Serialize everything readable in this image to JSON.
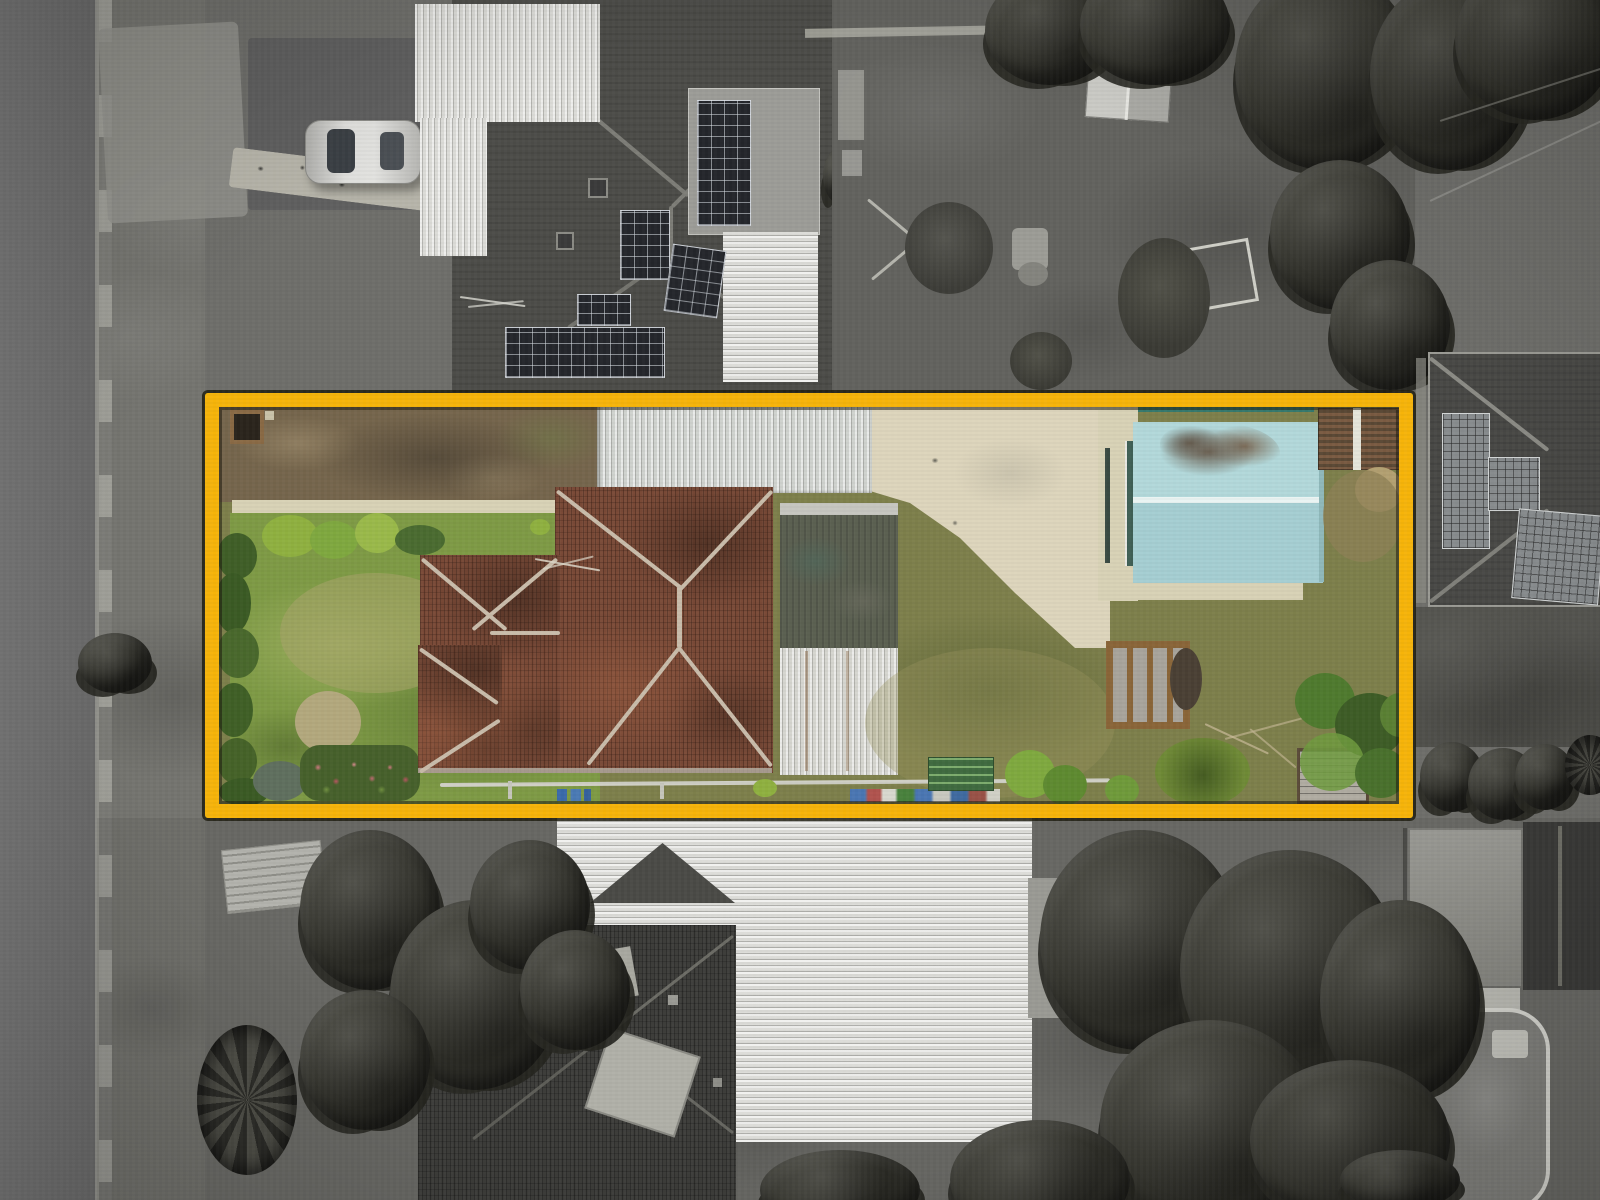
{
  "meta": {
    "kind": "aerial drone photograph (top-down real-estate shot)",
    "width_px": 1600,
    "height_px": 1200,
    "treatment": "surrounding neighbourhood desaturated to grayscale; highlighted lot shown in full colour",
    "visible_text": "none"
  },
  "highlight": {
    "label": "property boundary",
    "shape": "rectangle",
    "color": "#F6B40A",
    "outline": "#26241A",
    "x": 205,
    "y": 393,
    "width": 1208,
    "height": 425,
    "stroke_px": 14
  },
  "palette": {
    "base": "#6e6e6a",
    "road": "#6d6d6d",
    "verge": "#74746f",
    "yardDirtGray": "#62625e",
    "yardDark": "#50504b",
    "drivewayPad": "#5f5f5f",
    "roofDark": "#4d4d49",
    "roofDark2": "#494946",
    "roofDarkTile": "#3e3e3b",
    "grayRoof": "#8f8f89",
    "gableDark": "#393937",
    "corrLight": "#dcdcd8",
    "panelGray": "#9c9c97",
    "solarDark": "#24262b",
    "solarGray": "#888c8e",
    "trailerGray": "#b3b3ad",
    "carBody": "#d6d6d2",
    "poolWater": "#7d7d79",
    "poolDeck": "#b8b8b1",
    "lawnLeft": "#7e9a45",
    "lawnRight": "#7d7f4b",
    "dirt": "#75654c",
    "concrete": "#d8d2b6",
    "concreteDrive": "#ddd5bc",
    "terracotta": "#7a4a37",
    "ridgeCap": "#c9bcaa",
    "roofOldGreen": "#5c6152",
    "rearRoofWhite": "#d6d6d0",
    "carport": "#cfd2ce",
    "shedBlueTop": "#b2d8da",
    "shedBlueBottom": "#a5ced2",
    "shedRidge": "#eaf4f3",
    "rustShed": "#6e5948",
    "graySheds": "#b0aca2",
    "deckFrame": "#8a6538",
    "tealFence": "#2e7a72",
    "hedge": "#3f5e27",
    "bushBright": "#8fb040",
    "fern": "#6f8a36",
    "flowerBed": "#46602b"
  },
  "lot": {
    "features": [
      {
        "name": "main-house-tiled-roof",
        "desc": "terracotta hip roof with light ridge capping"
      },
      {
        "name": "old-green-metal-roof",
        "desc": "weathered green-grey rear section"
      },
      {
        "name": "white-rear-roof",
        "desc": "white corrugated rear extension"
      },
      {
        "name": "carport-roof",
        "desc": "long light corrugated roof along top boundary"
      },
      {
        "name": "concrete-driveway",
        "desc": "cream concrete with curved lawn edge"
      },
      {
        "name": "blue-shed",
        "desc": "pale blue gabled garage with rust patch and white ridge"
      },
      {
        "name": "rust-shed",
        "desc": "small rusty roof in top-right corner"
      },
      {
        "name": "timber-deck",
        "desc": "small timber-framed deck on rear lawn"
      },
      {
        "name": "dirt-strip",
        "desc": "bare brown earth along top-left"
      },
      {
        "name": "concrete-path",
        "desc": "narrow cream path below dirt strip"
      },
      {
        "name": "left-lawn",
        "desc": "green front lawn with worn patch"
      },
      {
        "name": "right-lawn",
        "desc": "olive rear lawn with worn patches"
      },
      {
        "name": "hedge-and-flowerbed",
        "desc": "dark hedge row and pink flower bed, bottom-left"
      },
      {
        "name": "boundary-clutter",
        "desc": "pipes, bins and shrubs along bottom fence"
      },
      {
        "name": "teal-fence-line",
        "desc": "teal fence along top boundary"
      }
    ]
  },
  "surroundings": {
    "features": [
      {
        "name": "street",
        "desc": "vertical road with footpath on left edge"
      },
      {
        "name": "neighbour-house-top-left",
        "desc": "dark hip roof, white corrugated sections, rooftop solar arrays"
      },
      {
        "name": "parked-car",
        "desc": "silver car on dark driveway pad"
      },
      {
        "name": "paver-path",
        "desc": "stepping-stone path with dark pavers"
      },
      {
        "name": "rear-yard-top",
        "desc": "bare grey yard, small gabled shed, crossed timbers, frame"
      },
      {
        "name": "neighbour-house-top-right",
        "desc": "hip roof with large solar arrays"
      },
      {
        "name": "big-white-roof-bottom",
        "desc": "large bright corrugated roof below the lot"
      },
      {
        "name": "neighbour-house-bottom",
        "desc": "dark tiled hip roof"
      },
      {
        "name": "trailer",
        "desc": "light trailer parked near street"
      },
      {
        "name": "palm-trees",
        "desc": "round palm canopies"
      },
      {
        "name": "tree-canopies",
        "desc": "dense dark trees lower right"
      },
      {
        "name": "swimming-pool",
        "desc": "oval pool with light coping, bottom-right"
      }
    ]
  }
}
